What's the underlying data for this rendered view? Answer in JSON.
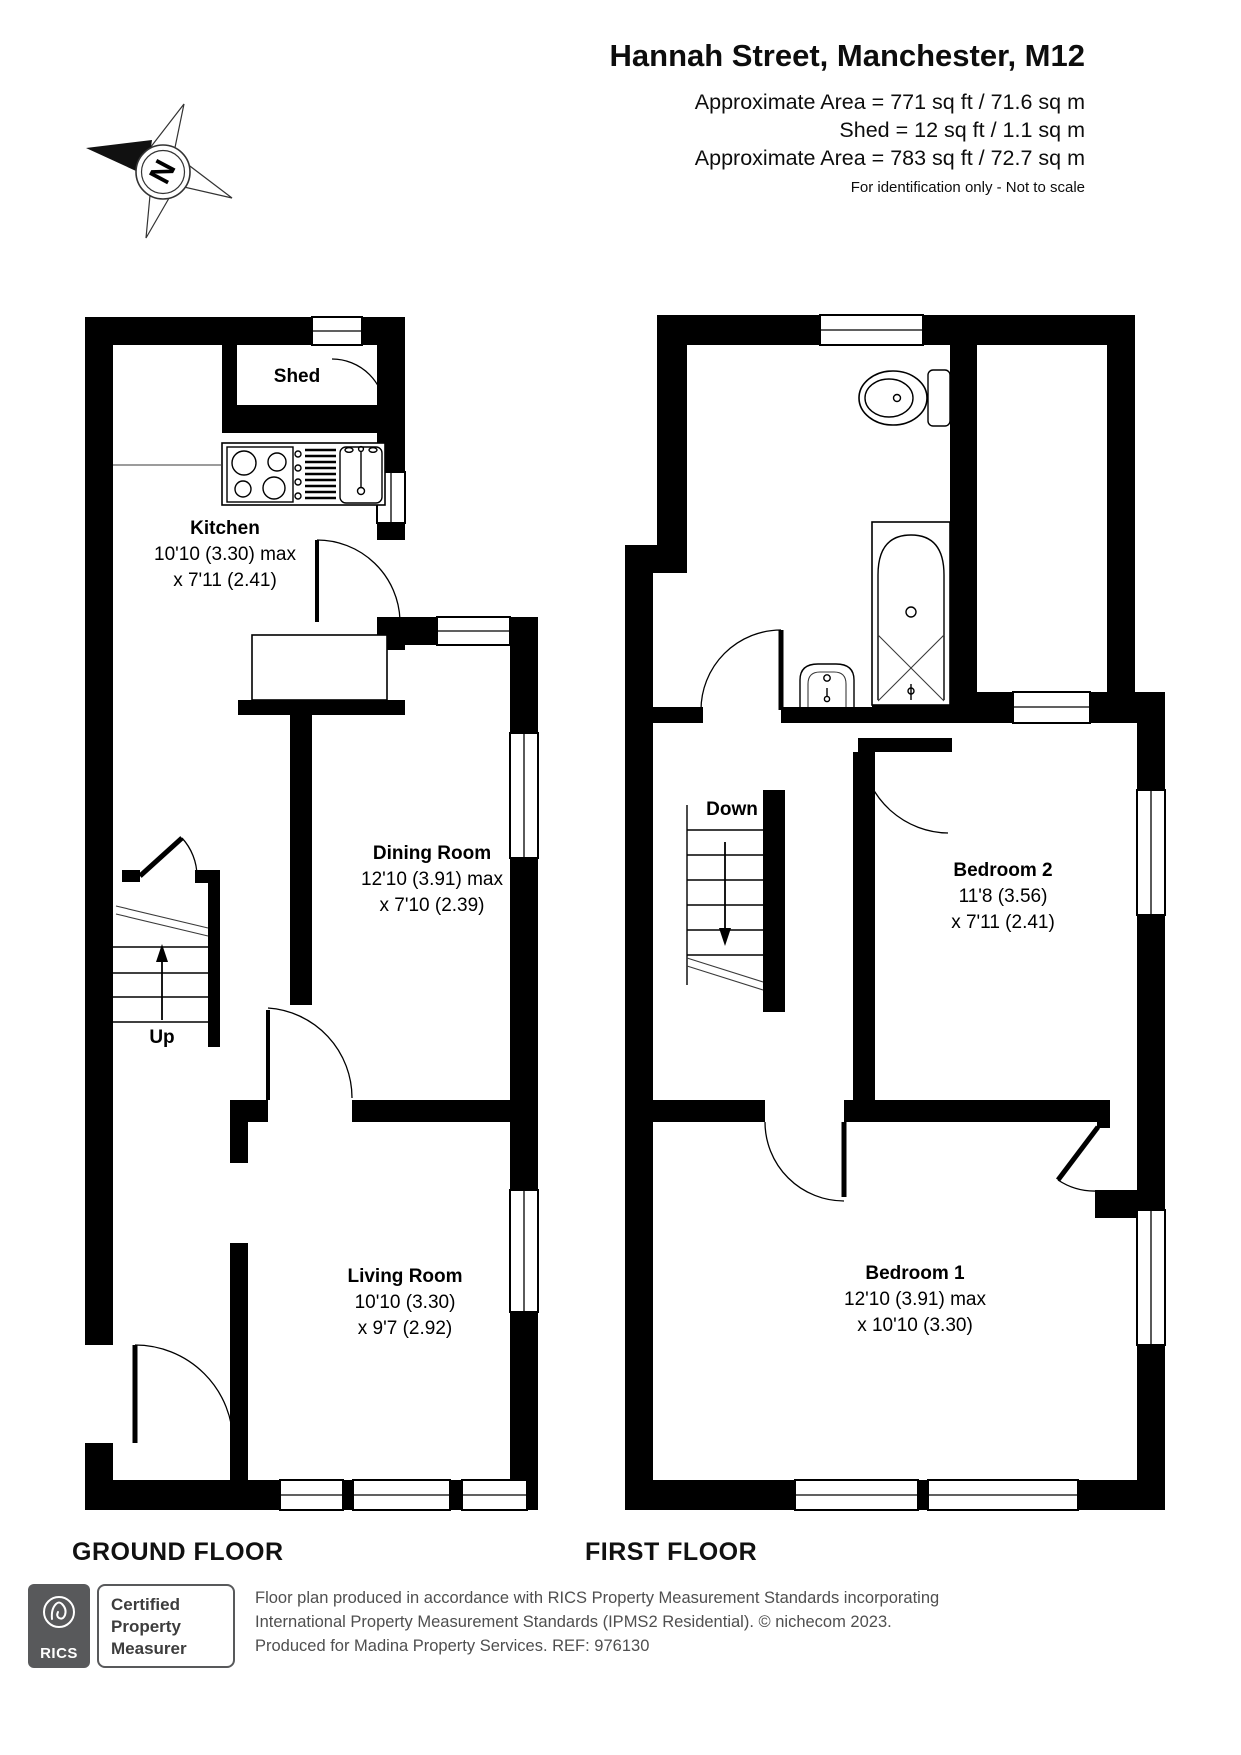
{
  "header": {
    "title": "Hannah Street, Manchester, M12",
    "area_line_1": "Approximate Area = 771 sq ft / 71.6 sq m",
    "area_line_2": "Shed = 12 sq ft / 1.1 sq m",
    "area_line_3": "Approximate Area = 783 sq ft / 72.7 sq m",
    "disclaimer": "For identification only - Not to scale",
    "compass_letter": "N"
  },
  "floors": {
    "ground": {
      "label": "GROUND FLOOR",
      "stairs_label": "Up",
      "rooms": {
        "shed": {
          "name": "Shed"
        },
        "kitchen": {
          "name": "Kitchen",
          "dim1": "10'10 (3.30) max",
          "dim2": "x 7'11 (2.41)"
        },
        "dining": {
          "name": "Dining Room",
          "dim1": "12'10 (3.91) max",
          "dim2": "x 7'10 (2.39)"
        },
        "living": {
          "name": "Living Room",
          "dim1": "10'10 (3.30)",
          "dim2": "x 9'7 (2.92)"
        }
      }
    },
    "first": {
      "label": "FIRST FLOOR",
      "stairs_label": "Down",
      "rooms": {
        "bedroom2": {
          "name": "Bedroom 2",
          "dim1": "11'8 (3.56)",
          "dim2": "x 7'11 (2.41)"
        },
        "bedroom1": {
          "name": "Bedroom 1",
          "dim1": "12'10 (3.91) max",
          "dim2": "x 10'10 (3.30)"
        }
      }
    }
  },
  "footer": {
    "rics_logo_text": "RICS",
    "badge_line_1": "Certified",
    "badge_line_2": "Property",
    "badge_line_3": "Measurer",
    "note_line_1": "Floor plan produced in accordance with RICS Property Measurement Standards incorporating",
    "note_line_2": "International Property Measurement Standards (IPMS2 Residential).   © nichecom 2023.",
    "note_line_3": "Produced for Madina Property Services.   REF: 976130"
  },
  "colors": {
    "wall": "#000000",
    "background": "#ffffff",
    "footer_text": "#4f4f4f",
    "logo_gray": "#58595b"
  }
}
